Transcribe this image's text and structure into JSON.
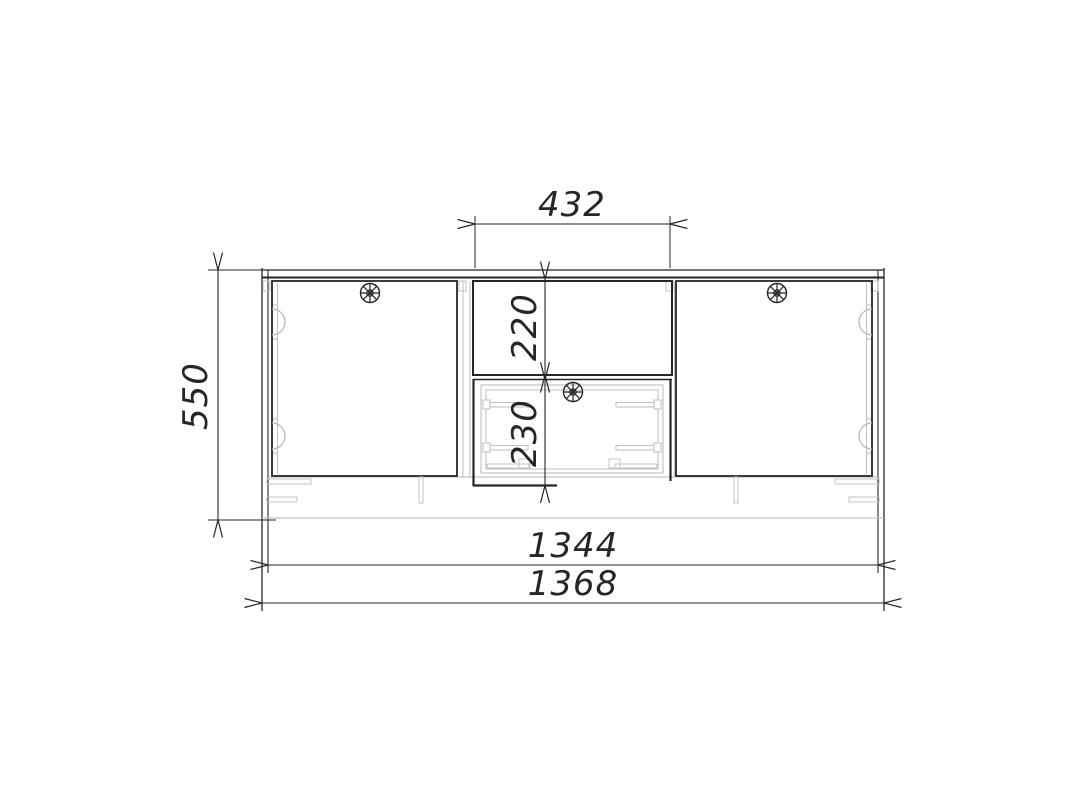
{
  "drawing": {
    "title": "cabinet-front-elevation-drawing",
    "dimensions": {
      "niche_width": "432",
      "overall_height": "550",
      "niche_height": "220",
      "drawer_height": "230",
      "inner_width": "1344",
      "overall_width": "1368"
    },
    "colors": {
      "outline": "#262626",
      "secondary_lines": "#c3c3c3",
      "background": "#ffffff"
    },
    "components": [
      "left-door",
      "open-niche",
      "drawer",
      "right-door",
      "cup-hinges",
      "round-knobs",
      "legs",
      "top-panel"
    ]
  }
}
